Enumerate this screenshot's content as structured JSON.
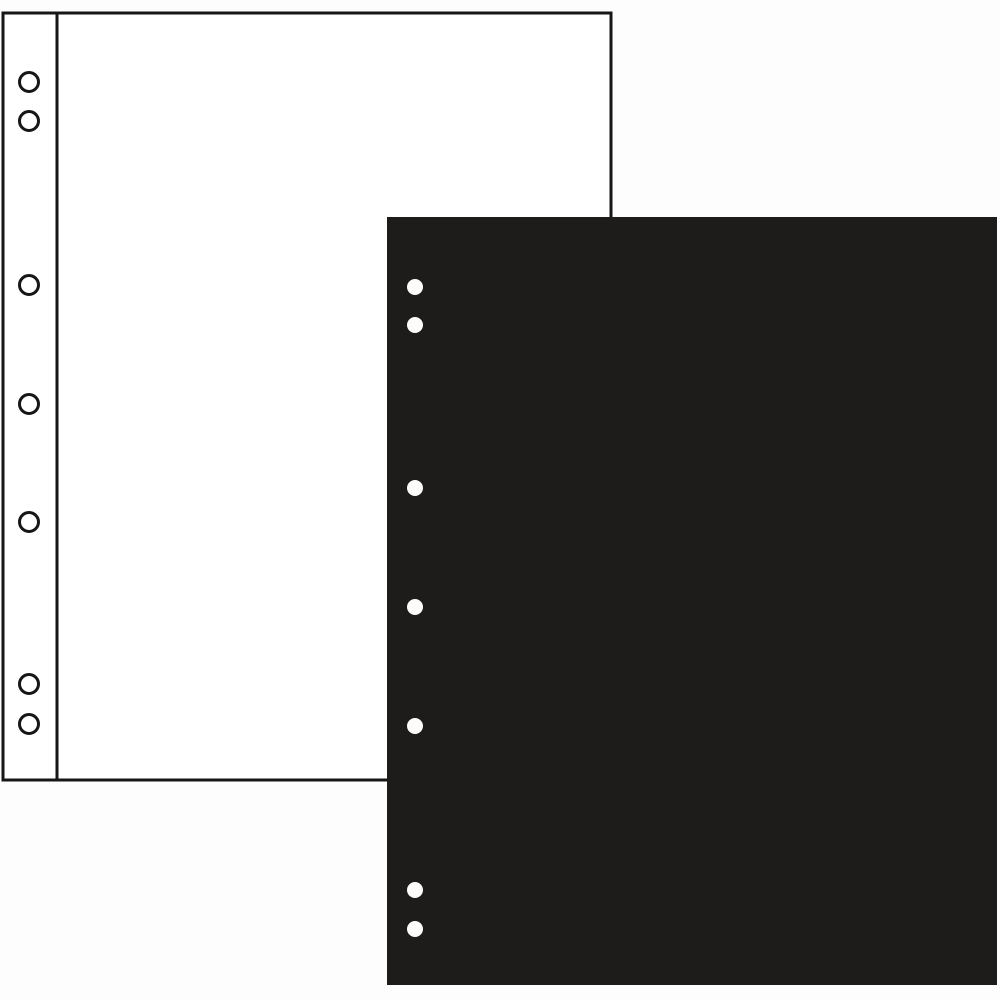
{
  "scene": {
    "description": "Product photo of two ring-binder album interleaf pages: a white outlined page behind and a solid black page in front, each punched with seven binder holes along the left edge",
    "background_color": "#fdfdfd",
    "white_page": {
      "label": "white-album-page",
      "x": 3,
      "y": 13,
      "width": 608,
      "height": 767,
      "fill": "#ffffff",
      "border_color": "#161616",
      "border_width": 3,
      "margin_line_x": 57,
      "margin_line_width": 3,
      "hole_style": "outlined-ring",
      "hole_cx": 29,
      "hole_cy": [
        82,
        121,
        285,
        404,
        522,
        684,
        724
      ],
      "hole_radius": 9.5,
      "hole_stroke_width": 3,
      "hole_stroke_color": "#161616",
      "hole_fill": "#ffffff"
    },
    "black_page": {
      "label": "black-album-page",
      "x": 387,
      "y": 217,
      "width": 610,
      "height": 768,
      "fill": "#1d1c1a",
      "hole_style": "solid-punched",
      "hole_cx": 415,
      "hole_cy": [
        287,
        325,
        488,
        607,
        726,
        890,
        929
      ],
      "hole_radius": 8,
      "hole_fill": "#fcfcfc"
    }
  }
}
